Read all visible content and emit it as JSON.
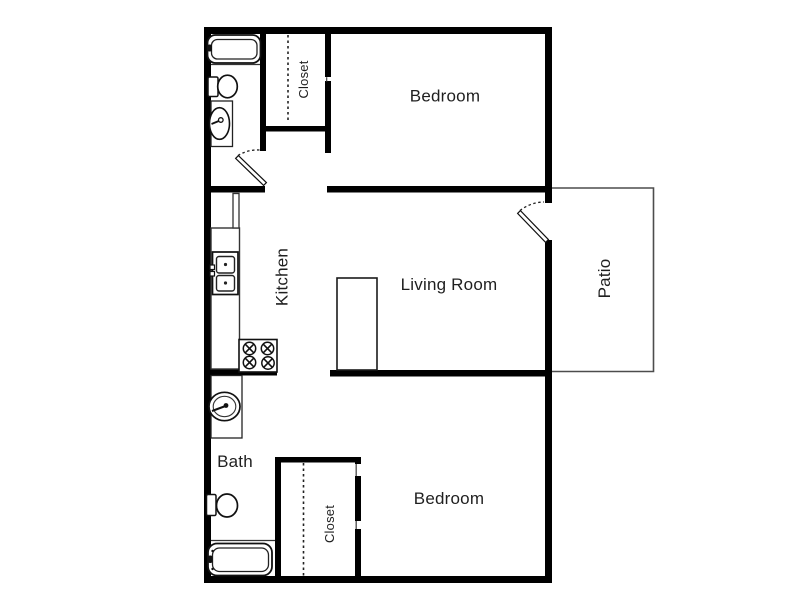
{
  "colors": {
    "background": "#ffffff",
    "walls": "#000000",
    "thin_lines": "#4d4d4d",
    "fixture_lines": "#111111",
    "label_text": "#1f1f1f"
  },
  "rooms": {
    "bedroom_top": {
      "label": "Bedroom"
    },
    "closet_top": {
      "label": "Closet"
    },
    "kitchen": {
      "label": "Kitchen"
    },
    "living_room": {
      "label": "Living Room"
    },
    "patio": {
      "label": "Patio"
    },
    "bath": {
      "label": "Bath"
    },
    "closet_bottom": {
      "label": "Closet"
    },
    "bedroom_bottom": {
      "label": "Bedroom"
    }
  },
  "fixtures": [
    "bathtub-icon",
    "toilet-icon",
    "vanity-sink-icon",
    "refrigerator-icon",
    "kitchen-counter",
    "double-basin-sink-icon",
    "stove-cooktop-icon",
    "breakfast-bar",
    "vanity-sink-icon",
    "toilet-icon",
    "bathtub-icon"
  ]
}
